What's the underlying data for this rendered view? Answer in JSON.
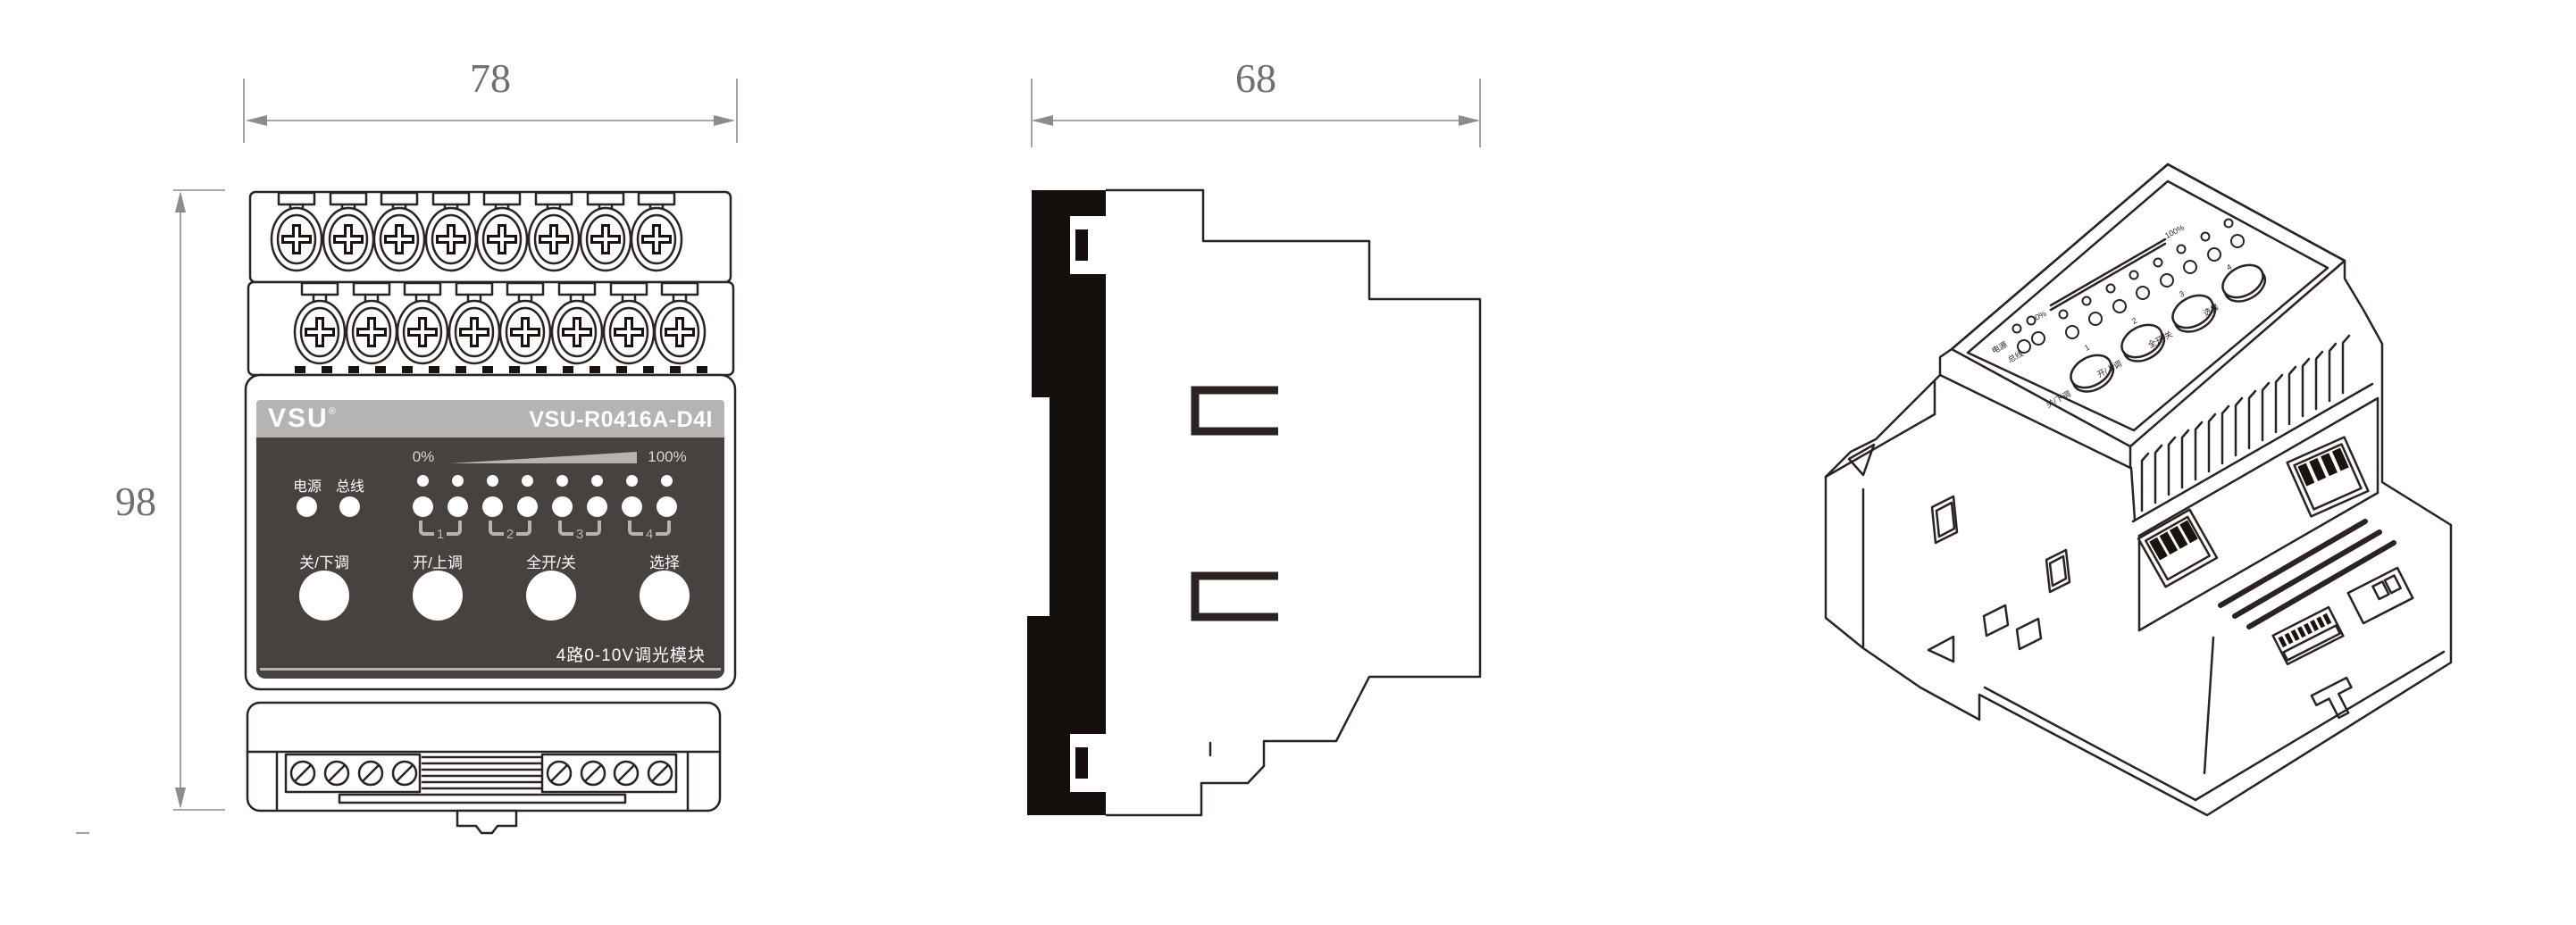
{
  "dimensions": {
    "front_width": "78",
    "front_height": "98",
    "side_depth": "68"
  },
  "front_view": {
    "brand": "VSU",
    "registered_mark": "®",
    "model": "VSU-R0416A-D4I",
    "panel": {
      "scale_min": "0%",
      "scale_max": "100%",
      "status_leds": [
        {
          "label": "电源"
        },
        {
          "label": "总线"
        }
      ],
      "channels": [
        {
          "number": "1"
        },
        {
          "number": "2"
        },
        {
          "number": "3"
        },
        {
          "number": "4"
        }
      ],
      "buttons": [
        {
          "label": "关/下调"
        },
        {
          "label": "开/上调"
        },
        {
          "label": "全开/关"
        },
        {
          "label": "选择"
        }
      ],
      "product_name": "4路0-10V调光模块"
    }
  },
  "colors": {
    "outline": "#2b2321",
    "label_band": "#b5b4b3",
    "panel_background": "#474140",
    "panel_accent": "#b5b4b3",
    "dimension_gray": "#8c8c8c",
    "led_white": "#ffffff"
  }
}
